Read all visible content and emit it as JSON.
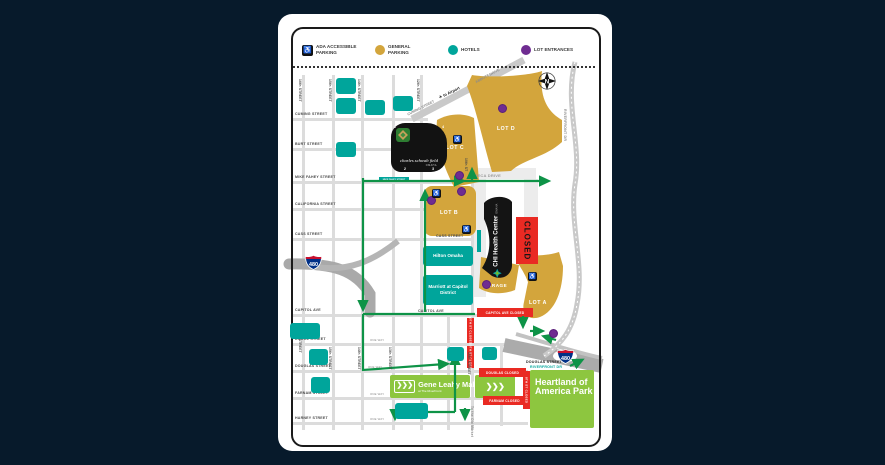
{
  "colors": {
    "background": "#071a2b",
    "card": "#ffffff",
    "general_parking_gold": "#d3a53c",
    "hotel_teal": "#00a59b",
    "lot_entrance_purple": "#6f2c91",
    "closed_red": "#e92a23",
    "route_green": "#0e9347",
    "park_green": "#8dc63f"
  },
  "legend": {
    "items": [
      {
        "icon": "ada-parking-icon",
        "label": "ADA ACCESSIBLE PARKING"
      },
      {
        "icon": "general-parking-dot",
        "label": "GENERAL PARKING"
      },
      {
        "icon": "hotels-dot",
        "label": "HOTELS"
      },
      {
        "icon": "lot-entrances-dot",
        "label": "LOT ENTRANCES"
      }
    ]
  },
  "streets": {
    "horizontal": [
      "CUMING STREET",
      "BURT STREET",
      "MIKE FAHEY STREET",
      "CALIFORNIA STREET",
      "CASS STREET",
      "CAPITOL AVE",
      "DODGE STREET",
      "DOUGLAS STREET",
      "FARNAM STREET",
      "HARNEY STREET"
    ],
    "vertical_top": [
      "16th STREET",
      "15th STREET",
      "14th STREET",
      "12th STREET"
    ],
    "vertical_mid": [
      "10th ST"
    ],
    "vertical_bottom": [
      "16th STREET",
      "15th STREET",
      "14th STREET",
      "13th STREET",
      "10th STREET"
    ],
    "cass_mid": "CASS STREET",
    "capitol_mid": "CAPITOL AVE",
    "meca_drive": "MECA DRIVE",
    "douglas_se": "DOUGLAS STREET",
    "riverfront_se": "RIVERFRONT DR",
    "riverfront_dr": "RIVERFRONT DR",
    "cuming_diagonal": "CUMING STREET",
    "abbott_drive": "ABBOTT DRIVE",
    "mike_fahey_tag": "MIKE FAHEY STREET",
    "one_way": "ONE WAY",
    "to_airport": "to Airport",
    "to_old_market": "To the Old Market"
  },
  "lots": {
    "lot_a": "LOT A",
    "lot_b": "LOT B",
    "lot_c": "LOT C",
    "lot_d": "LOT D",
    "garage": "GARAGE"
  },
  "venues": {
    "stadium": {
      "name": "charles schwab field",
      "city": "OMAHA",
      "gates": [
        "1",
        "4",
        "2",
        "3"
      ]
    },
    "arena": {
      "name": "CHI Health Center",
      "city": "OMAHA"
    },
    "closed": "CLOSED"
  },
  "hotels": {
    "hilton": "Hilton Omaha",
    "marriott": "Marriott at Capitol District"
  },
  "parks": {
    "gene_leahy_title": "Gene Leahy Mall",
    "gene_leahy_sub": "at The RiverFront",
    "heartland": "Heartland of America Park"
  },
  "closures": {
    "capitol": "CAPITOL AVE CLOSED",
    "tenth_upper": "10TH ST CLOSED",
    "tenth_lower": "10TH ST CLOSED",
    "douglas": "DOUGLAS CLOSED",
    "farnam": "FARNAM CLOSED",
    "eighth": "8TH ST CLOSED"
  },
  "interstate": {
    "number": "480"
  },
  "compass": {
    "label": "N"
  },
  "icons": {
    "plane": "✈",
    "chevron": "❯",
    "wheelchair": "♿"
  }
}
